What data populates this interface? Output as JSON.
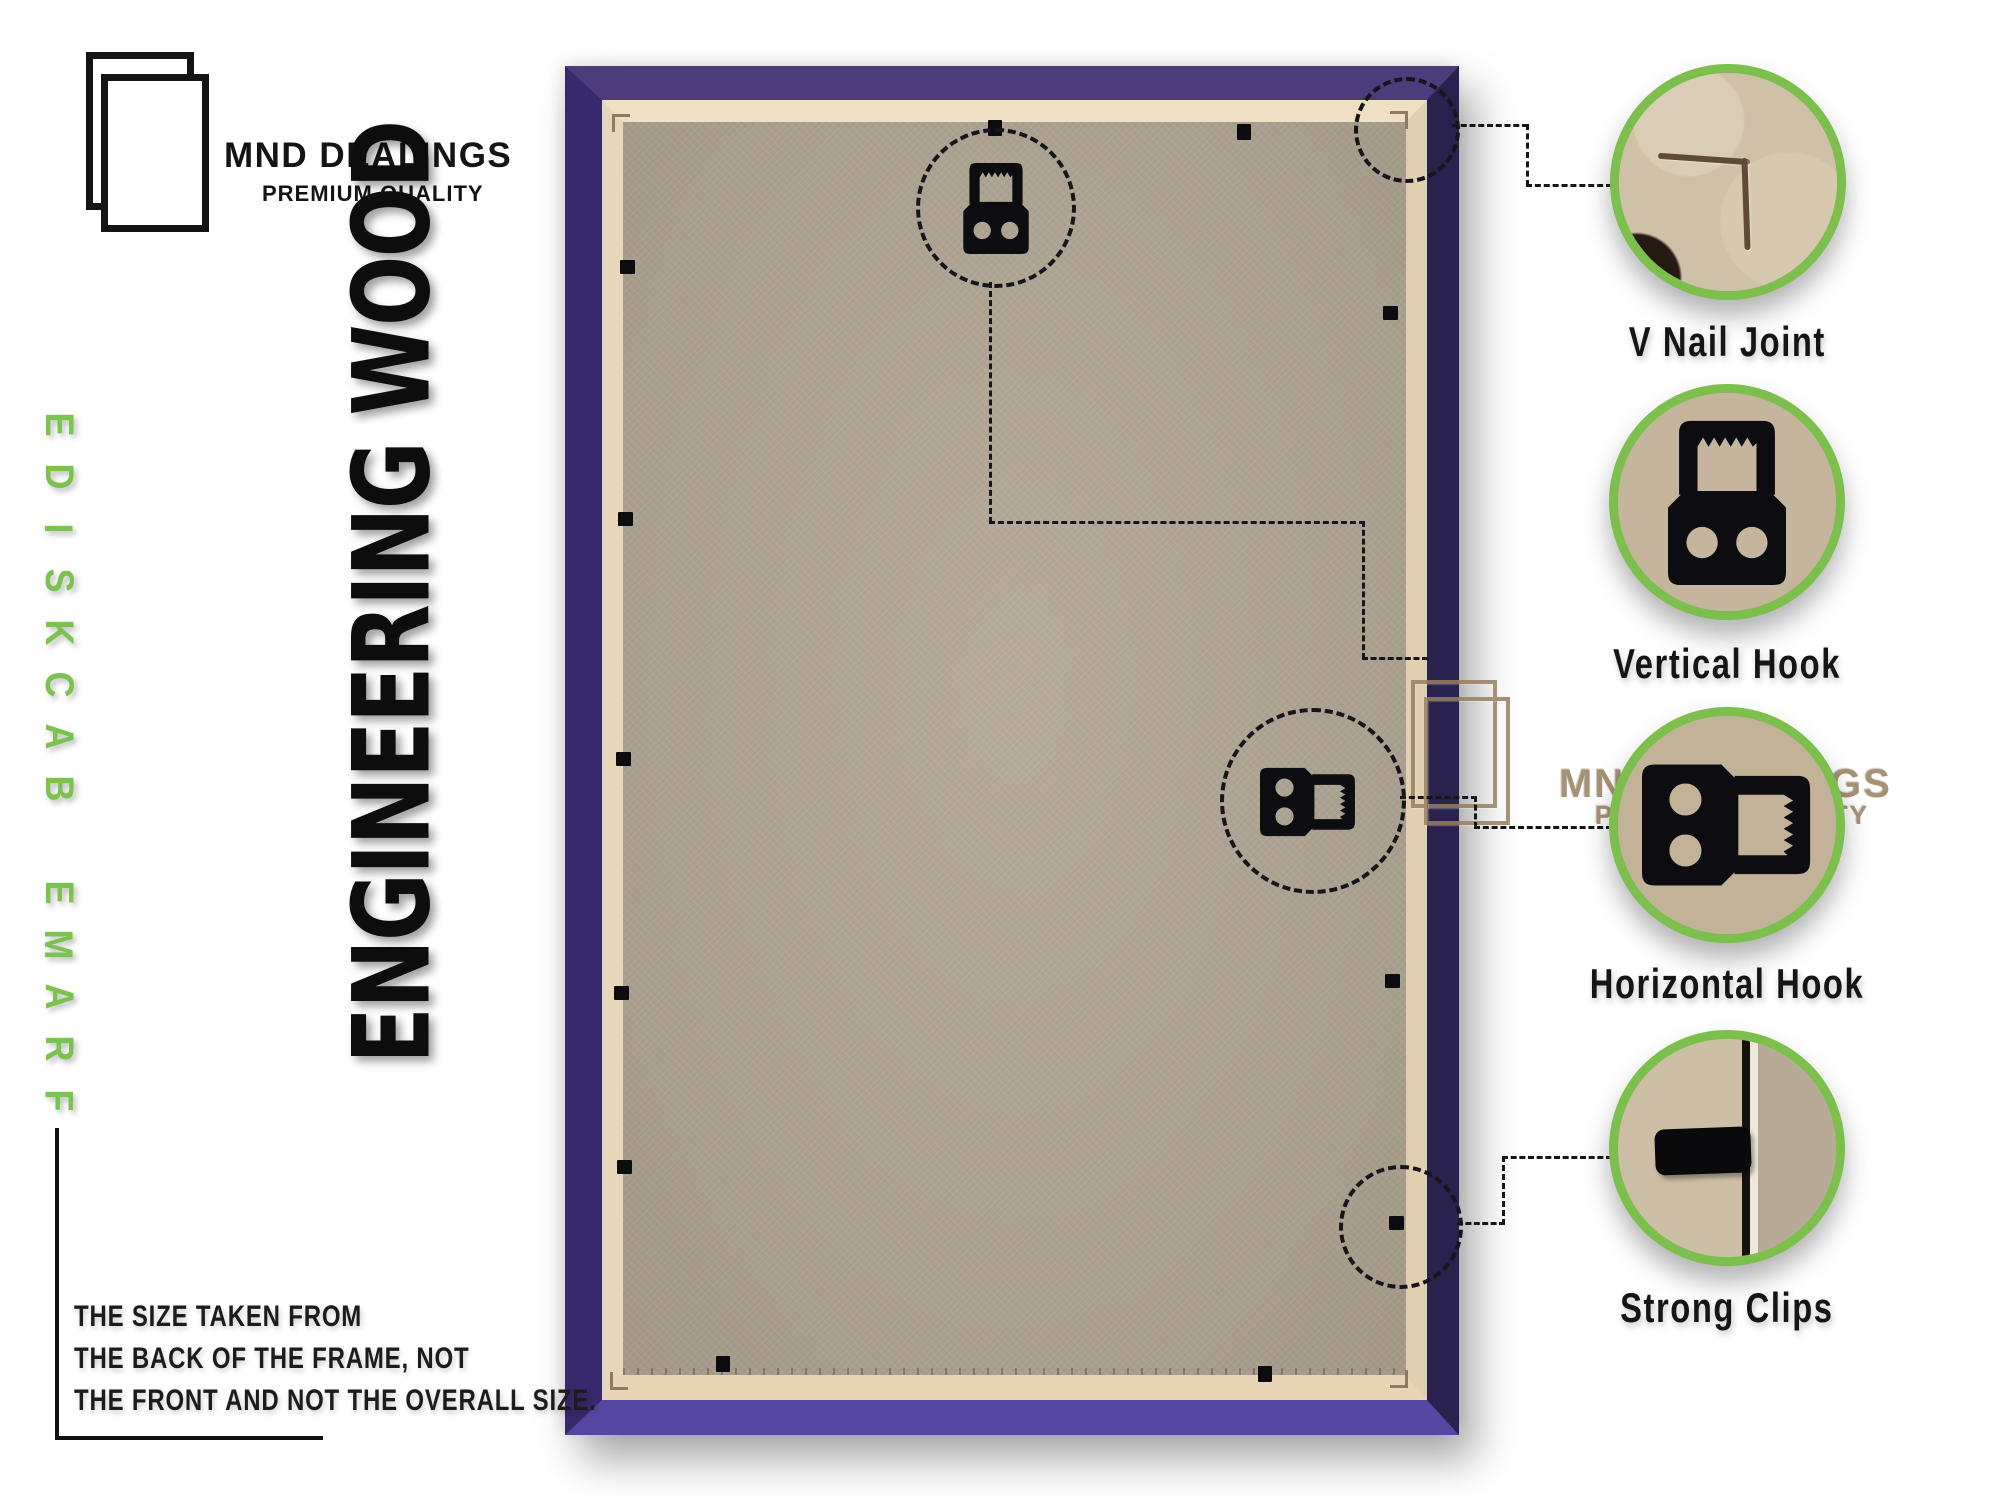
{
  "header": {
    "brand": "MND DEALINGS",
    "tagline": "PREMIUM QUALITY"
  },
  "left_rail": {
    "vertical_text": "FRAME BACKSIDE",
    "material_text": "ENGINEERING WOOD"
  },
  "watermark": {
    "brand": "MND DEALINGS",
    "tagline": "PREMIUM QUALITY"
  },
  "callouts": [
    {
      "id": "v-nail-joint",
      "label": "V Nail Joint"
    },
    {
      "id": "vertical-hook",
      "label": "Vertical Hook"
    },
    {
      "id": "horizontal-hook",
      "label": "Horizontal Hook"
    },
    {
      "id": "strong-clips",
      "label": "Strong Clips"
    }
  ],
  "note": {
    "lines": [
      "THE SIZE TAKEN FROM",
      "THE BACK OF THE FRAME, NOT",
      "THE FRONT AND NOT THE OVERALL SIZE."
    ]
  },
  "colors": {
    "accent_green": "#7cbf4d",
    "rail_green": "#7cc24e",
    "frame_purple_top": "#4c3c7c",
    "frame_purple_right": "#29224f",
    "frame_purple_bottom": "#5547a1",
    "frame_purple_left": "#37296b",
    "lip_beige": "#e9dcc0",
    "backboard_tan": "#b1a694",
    "watermark_brown": "#97815f",
    "text_black": "#141414"
  }
}
